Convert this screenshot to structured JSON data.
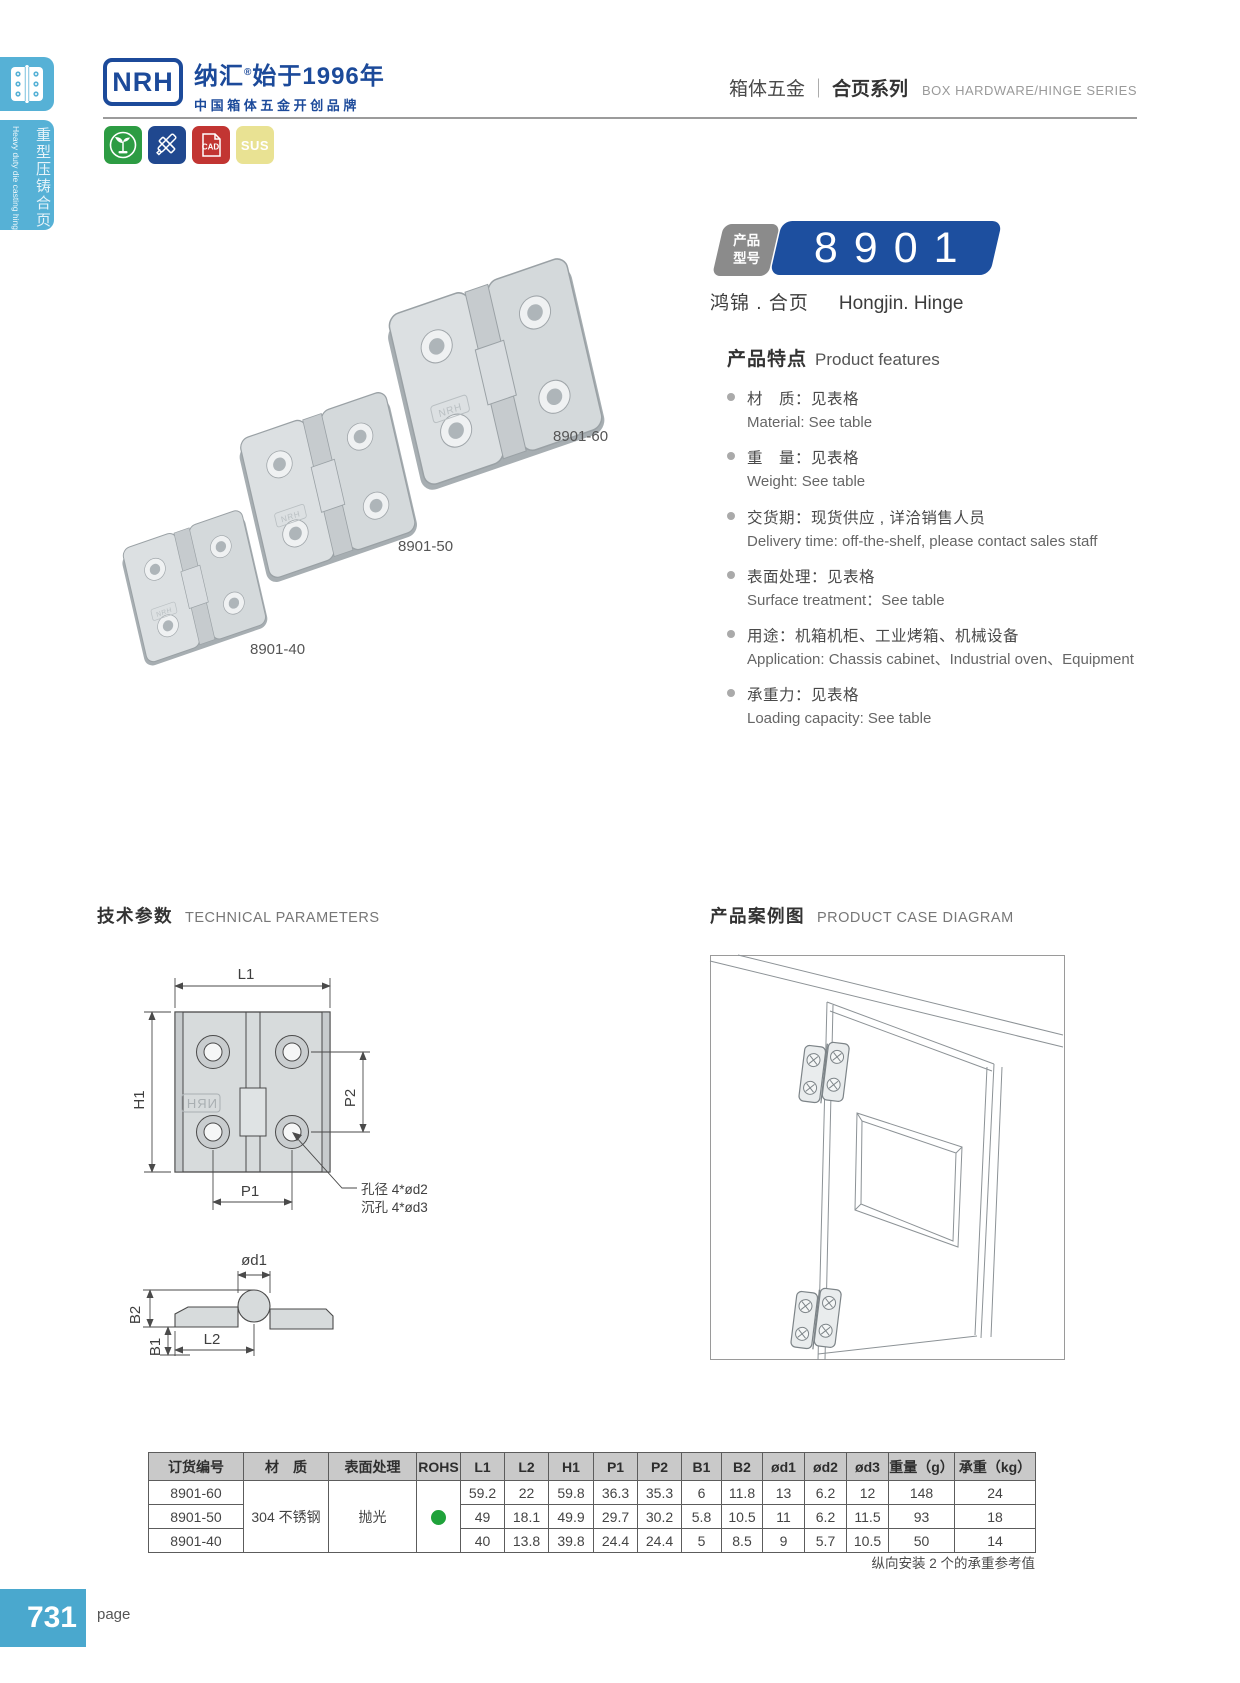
{
  "header": {
    "logo_text": "NRH",
    "brand_name": "纳汇",
    "brand_reg": "®",
    "brand_rest": "始于1996年",
    "brand_line2": "中国箱体五金开创品牌",
    "series_cn_left": "箱体五金",
    "series_sep": "｜",
    "series_cn_right": "合页系列",
    "series_en": "BOX HARDWARE/HINGE SERIES"
  },
  "sidebar": {
    "category_cn": "重型压铸合页",
    "category_en": "Heavy duty die casting hinge"
  },
  "badges": {
    "cad_label": "CAD",
    "sus_label": "SUS"
  },
  "product": {
    "model_tag_line1": "产品",
    "model_tag_line2": "型号",
    "model": "8901",
    "name_cn": "鸿锦 . 合页",
    "name_en": "Hongjin. Hinge",
    "photo_labels": [
      "8901-60",
      "8901-50",
      "8901-40"
    ]
  },
  "features": {
    "title_cn": "产品特点",
    "title_en": "Product features",
    "items": [
      {
        "cn": "材　质：见表格",
        "en": "Material: See table"
      },
      {
        "cn": "重　量：见表格",
        "en": "Weight: See table"
      },
      {
        "cn": "交货期：现货供应 , 详洽销售人员",
        "en": "Delivery time: off-the-shelf, please contact sales staff"
      },
      {
        "cn": "表面处理：见表格",
        "en": "Surface treatment：See table"
      },
      {
        "cn": "用途：机箱机柜、工业烤箱、机械设备",
        "en": "Application: Chassis cabinet、Industrial oven、Equipment"
      },
      {
        "cn": "承重力：见表格",
        "en": "Loading capacity: See table"
      }
    ]
  },
  "sections": {
    "tech_cn": "技术参数",
    "tech_en": "TECHNICAL PARAMETERS",
    "case_cn": "产品案例图",
    "case_en": "PRODUCT CASE DIAGRAM"
  },
  "drawing": {
    "dim_l1": "L1",
    "dim_h1": "H1",
    "dim_p1": "P1",
    "dim_p2": "P2",
    "dim_od1": "ød1",
    "dim_b1": "B1",
    "dim_b2": "B2",
    "dim_l2": "L2",
    "hole_note1": "孔径 4*ød2",
    "hole_note2": "沉孔 4*ød3",
    "logo_mark": "NRH"
  },
  "table": {
    "headers": [
      "订货编号",
      "材　质",
      "表面处理",
      "ROHS",
      "L1",
      "L2",
      "H1",
      "P1",
      "P2",
      "B1",
      "B2",
      "ød1",
      "ød2",
      "ød3",
      "重量（g）",
      "承重（kg）"
    ],
    "material": "304 不锈钢",
    "surface": "抛光",
    "rows": [
      {
        "order_no": "8901-60",
        "values": [
          "59.2",
          "22",
          "59.8",
          "36.3",
          "35.3",
          "6",
          "11.8",
          "13",
          "6.2",
          "12",
          "148",
          "24"
        ]
      },
      {
        "order_no": "8901-50",
        "values": [
          "49",
          "18.1",
          "49.9",
          "29.7",
          "30.2",
          "5.8",
          "10.5",
          "11",
          "6.2",
          "11.5",
          "93",
          "18"
        ]
      },
      {
        "order_no": "8901-40",
        "values": [
          "40",
          "13.8",
          "39.8",
          "24.4",
          "24.4",
          "5",
          "8.5",
          "9",
          "5.7",
          "10.5",
          "50",
          "14"
        ]
      }
    ],
    "note": "纵向安装 2 个的承重参考值"
  },
  "footer": {
    "page_number": "731",
    "page_label": "page"
  }
}
